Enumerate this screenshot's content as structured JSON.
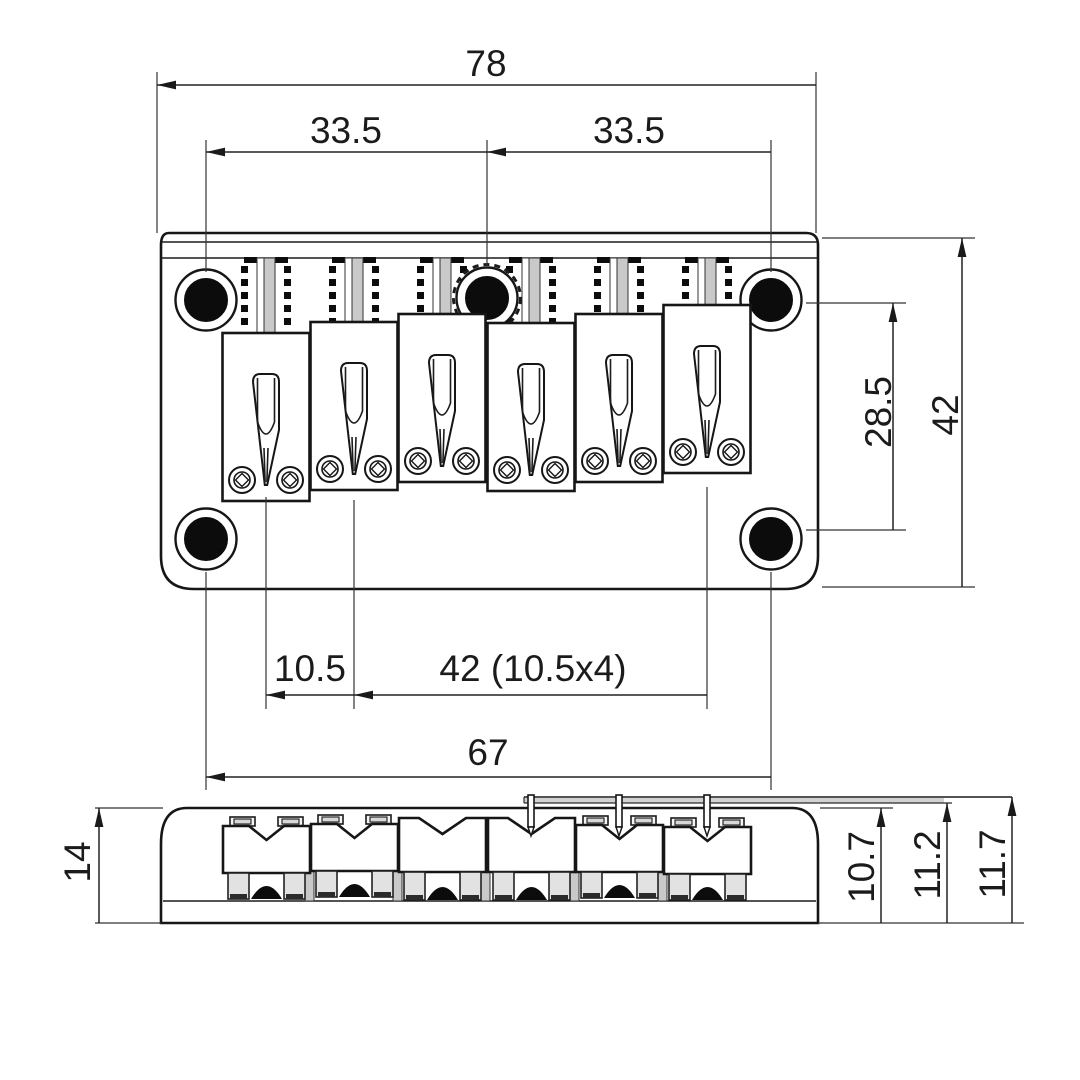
{
  "meta": {
    "background_color": "#ffffff",
    "line_color": "#161616",
    "shade_color": "#c9c9c9",
    "drawing_type": "guitar-bridge-dimension-drawing",
    "units_implied": "mm"
  },
  "top_view": {
    "dim_overall_width": "78",
    "dim_hole_span_left": "33.5",
    "dim_hole_span_right": "33.5",
    "dim_hole_row_spacing": "28.5",
    "dim_overall_depth": "42",
    "dim_string_spacing": "10.5",
    "dim_string_span": "42 (10.5x4)",
    "dim_mount_screw_span": "67"
  },
  "side_view": {
    "dim_overall_height": "14",
    "dim_height_inner": "10.7",
    "dim_height_mid": "11.2",
    "dim_height_outer": "11.7"
  }
}
